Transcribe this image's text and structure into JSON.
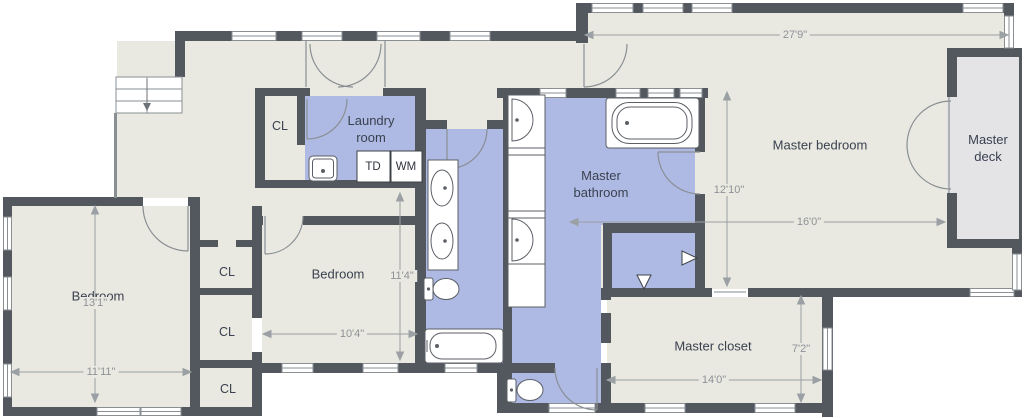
{
  "rooms": {
    "master_bedroom": "Master bedroom",
    "master_deck": "Master deck",
    "master_bathroom": "Master bathroom",
    "master_closet": "Master closet",
    "laundry_room": "Laundry room",
    "bedroom_left": "Bedroom",
    "bedroom_center": "Bedroom"
  },
  "closets": {
    "hall_closet": "CL",
    "closet_1": "CL",
    "closet_2": "CL",
    "closet_3": "CL"
  },
  "appliances": {
    "tumble_dryer": "TD",
    "washing_machine": "WM"
  },
  "dimensions": {
    "master_bedroom_width": "27'9\"",
    "master_bedroom_height": "12'10\"",
    "master_bedroom_lower_width": "16'0\"",
    "bedroom_left_height": "13'1\"",
    "bedroom_left_width": "11'11\"",
    "bedroom_center_width": "10'4\"",
    "bedroom_center_height": "11'4\"",
    "master_closet_height": "7'2\"",
    "master_closet_width": "14'0\""
  },
  "colors": {
    "floor": "#e9e9e1",
    "wet_room": "#aebae4",
    "deck": "#e4e4e7",
    "wall": "#53575e",
    "dimension": "#9aa0a3"
  }
}
